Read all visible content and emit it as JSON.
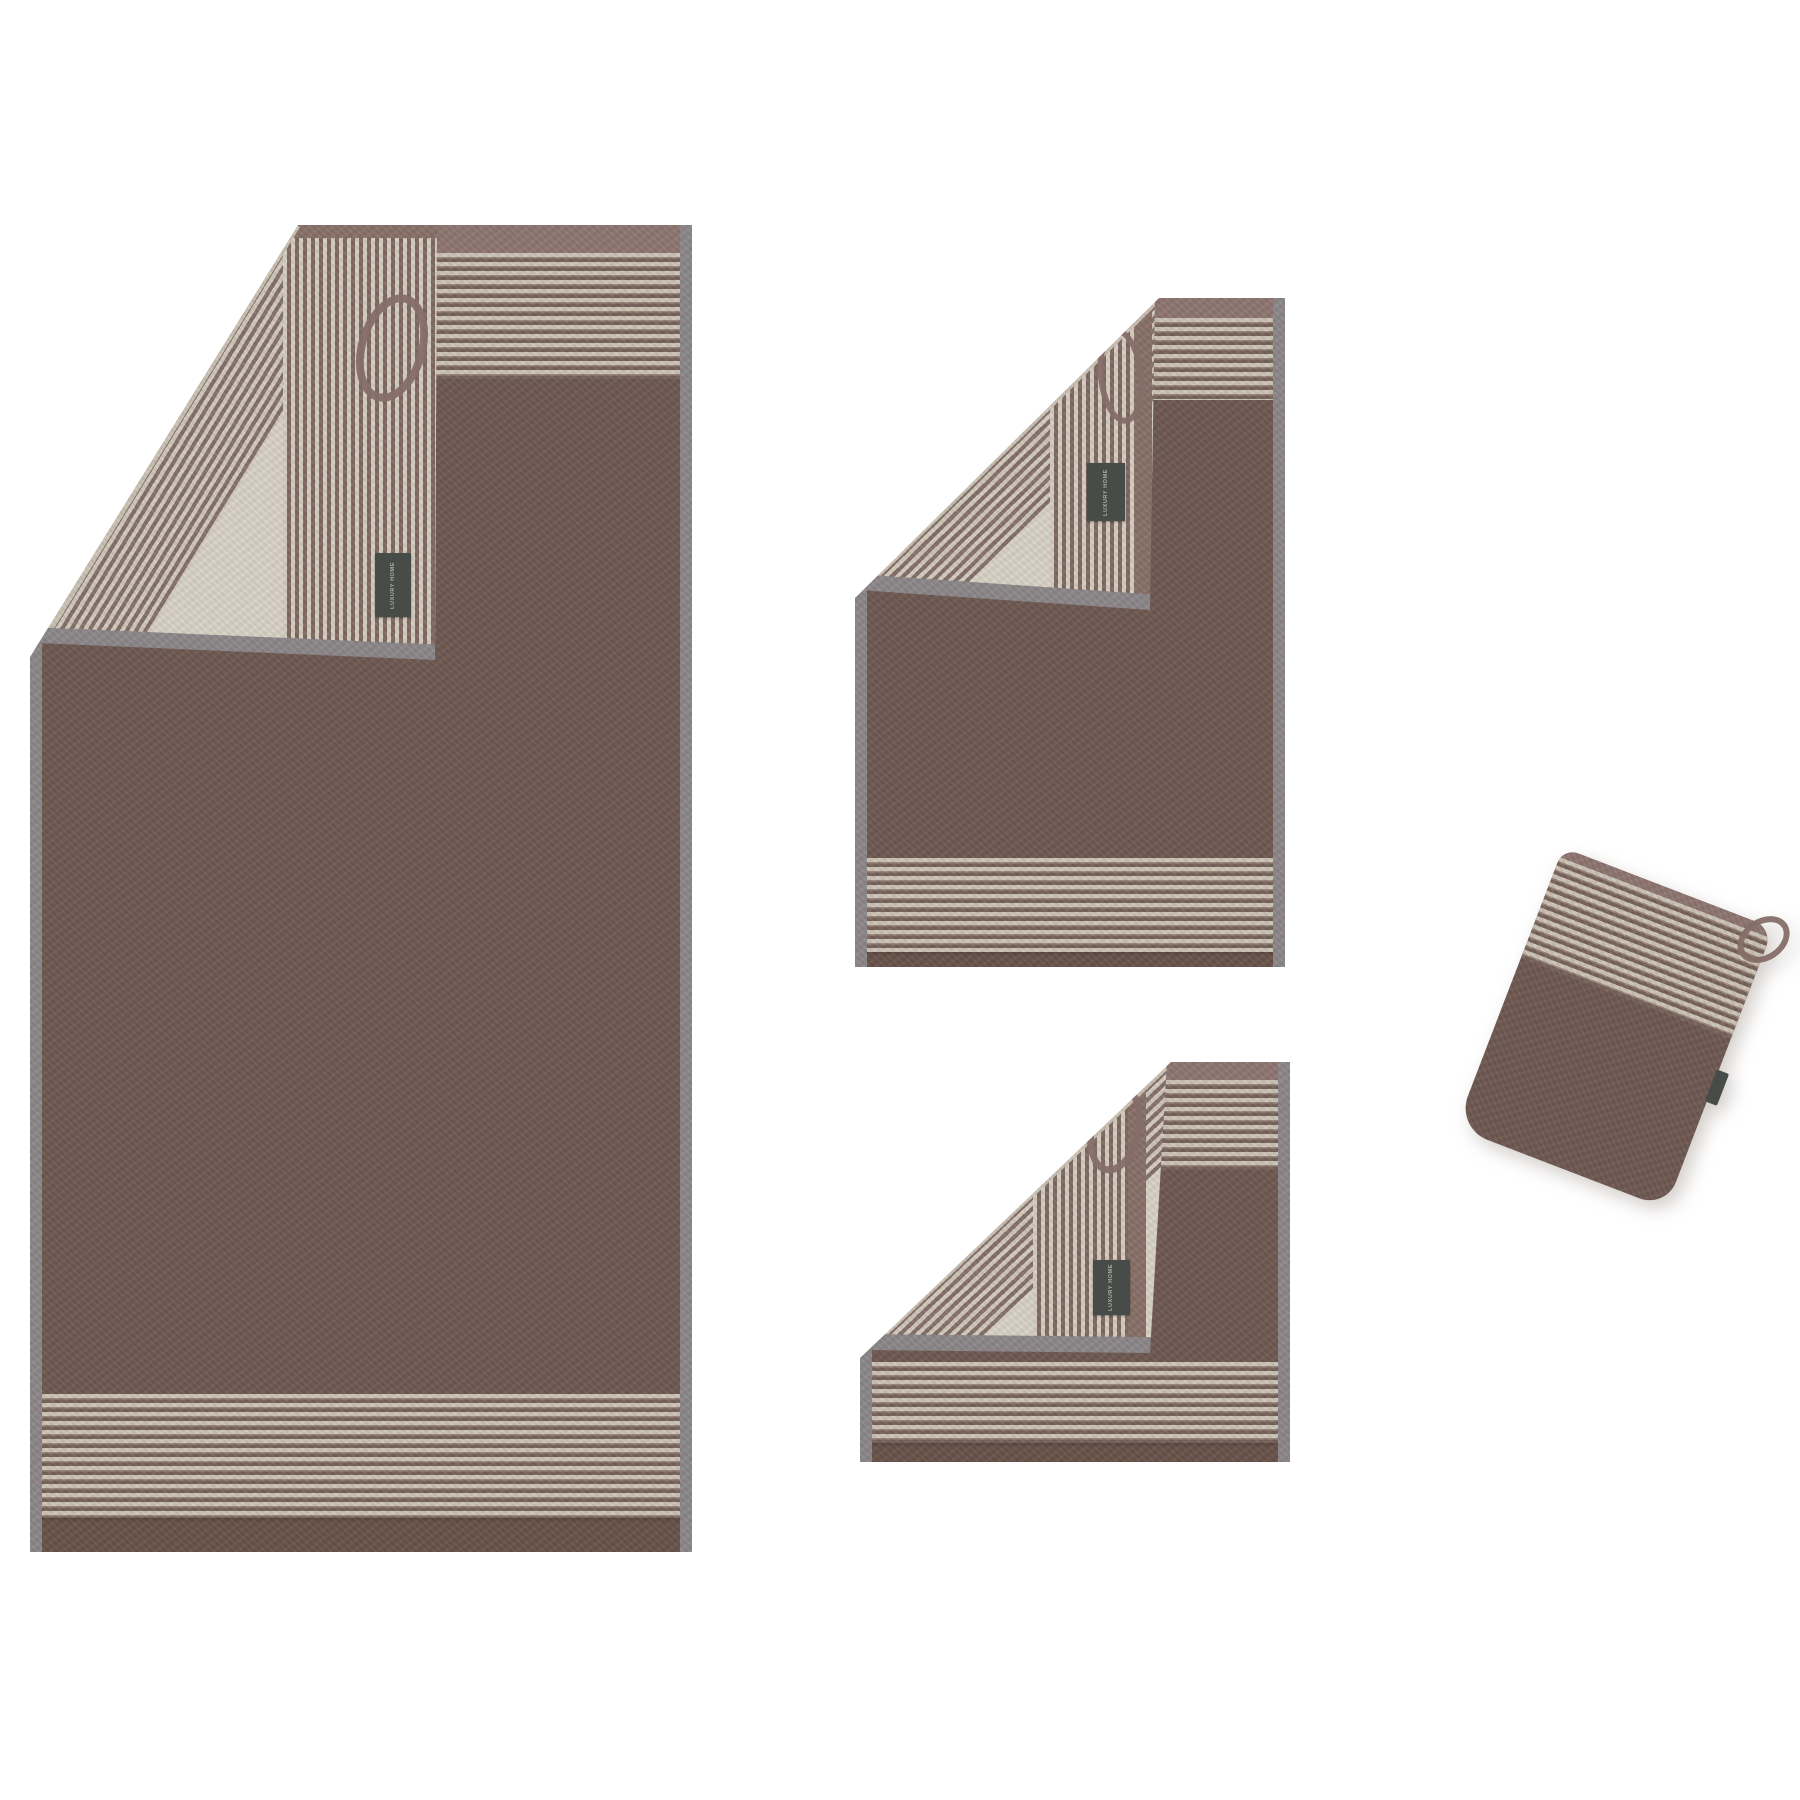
{
  "scene": {
    "background_color": "#ffffff"
  },
  "palette": {
    "towel_brown": "#6d5751",
    "towel_hem_brown": "#675249",
    "reverse_beige": "#d9d3c7",
    "stripe_light": "#cdc5b7",
    "stripe_dark": "#74615a",
    "side_hem_gray": "#8b8789",
    "trim_mauve": "#8d7570",
    "label_background": "#474c48",
    "label_text_color": "#a9afaa",
    "loop_brown": "#866e68"
  },
  "items": [
    {
      "id": "bath-towel",
      "brand_label": "LUXURY HOME"
    },
    {
      "id": "hand-towel",
      "brand_label": "LUXURY HOME"
    },
    {
      "id": "guest-towel",
      "brand_label": "LUXURY HOME"
    },
    {
      "id": "wash-mitt"
    }
  ]
}
